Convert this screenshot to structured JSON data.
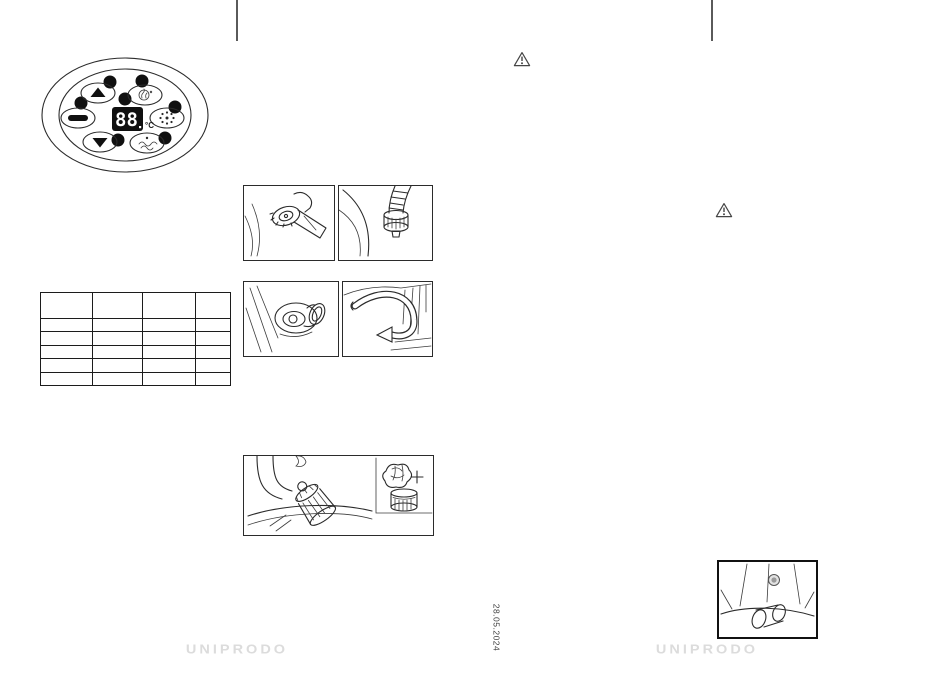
{
  "page": {
    "date_mark": "28.05.2024",
    "footer_brand_left": "UNIPRODO",
    "footer_brand_right": "UNIPRODO"
  },
  "control_panel": {
    "display_value": "88",
    "display_unit": "°C",
    "buttons": [
      {
        "id": "temp-up-button",
        "icon": "up-arrow-icon"
      },
      {
        "id": "heater-button",
        "icon": "heater-icon"
      },
      {
        "id": "jet-button",
        "icon": "jet-icon"
      },
      {
        "id": "bubble-button",
        "icon": "bubbles-icon"
      },
      {
        "id": "temp-down-button",
        "icon": "down-arrow-icon"
      },
      {
        "id": "massage-button",
        "icon": "massage-jets-icon"
      }
    ]
  },
  "table": {
    "columns": [
      "",
      "",
      "",
      ""
    ],
    "rows": [
      [
        "",
        "",
        "",
        ""
      ],
      [
        "",
        "",
        "",
        ""
      ],
      [
        "",
        "",
        "",
        ""
      ],
      [
        "",
        "",
        "",
        ""
      ],
      [
        "",
        "",
        "",
        ""
      ]
    ]
  },
  "colors": {
    "line_art": "#2b2b2b",
    "fold_mark": "#5a5a5a",
    "logo_gray": "#dcdcdc",
    "display_background": "#101010",
    "display_digits": "#ffffff"
  }
}
